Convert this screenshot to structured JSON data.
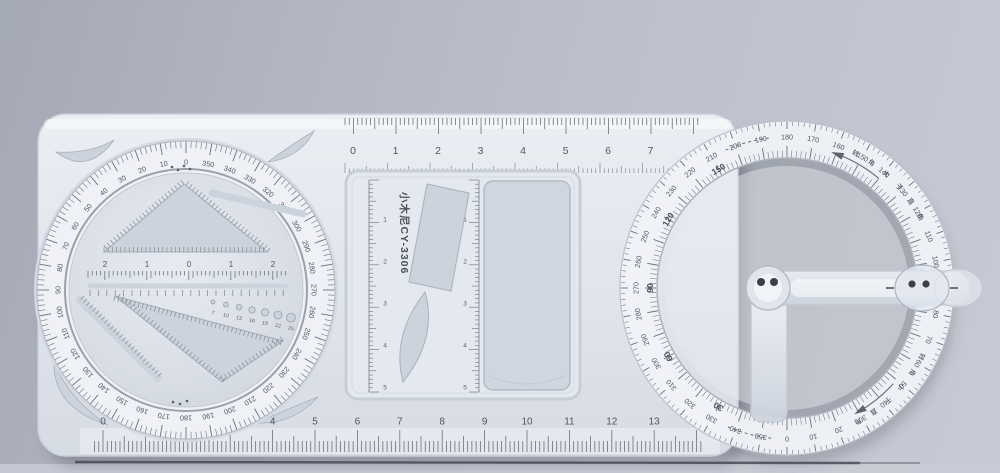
{
  "device": {
    "brand_label": "小木尼CY-3306",
    "top_ruler_labels": [
      "0",
      "1",
      "2",
      "3",
      "4",
      "5",
      "6",
      "7"
    ],
    "bottom_ruler_labels": [
      "0",
      "1",
      "2",
      "3",
      "4",
      "5",
      "6",
      "7",
      "8",
      "9",
      "10",
      "11",
      "12",
      "13"
    ],
    "left_dial": {
      "degree_labels": [
        "0",
        "10",
        "20",
        "30",
        "40",
        "50",
        "60",
        "70",
        "80",
        "90",
        "100",
        "110",
        "120",
        "130",
        "140",
        "150",
        "160",
        "170",
        "180",
        "190",
        "200",
        "210",
        "220",
        "230",
        "240",
        "250",
        "260",
        "270",
        "280",
        "290",
        "300",
        "310",
        "320",
        "330",
        "340",
        "350"
      ],
      "center_ruler_labels": [
        "2",
        "1",
        "0",
        "1",
        "2"
      ],
      "circle_template_labels": [
        "7",
        "10",
        "13",
        "16",
        "19",
        "22",
        "25"
      ]
    },
    "middle_panel": {
      "left_ruler_labels": [
        "1",
        "2",
        "3",
        "4",
        "5"
      ],
      "right_ruler_labels": [
        "1",
        "2",
        "3",
        "4",
        "5"
      ]
    },
    "right_protractor": {
      "degree_labels": [
        "0",
        "10",
        "20",
        "30",
        "40",
        "50",
        "60",
        "70",
        "80",
        "90",
        "100",
        "110",
        "120",
        "130",
        "140",
        "150",
        "160",
        "170",
        "180",
        "190",
        "200",
        "210",
        "220",
        "230",
        "240",
        "250",
        "260",
        "270",
        "280",
        "290",
        "300",
        "310",
        "320",
        "330",
        "340",
        "350"
      ],
      "helper_labels": [
        "30",
        "60",
        "90",
        "120",
        "150"
      ],
      "arc_text_upper": "转角大于直角",
      "arc_text_lower": "转角小于直角"
    },
    "colors": {
      "background": "#b4b8c4",
      "body": "#e1e5ec",
      "scale_face": "#eff1f6",
      "cutout": "#ccd3dc",
      "tick": "#6b7079",
      "label": "#52575f",
      "shadow_line": "#484b53"
    }
  }
}
